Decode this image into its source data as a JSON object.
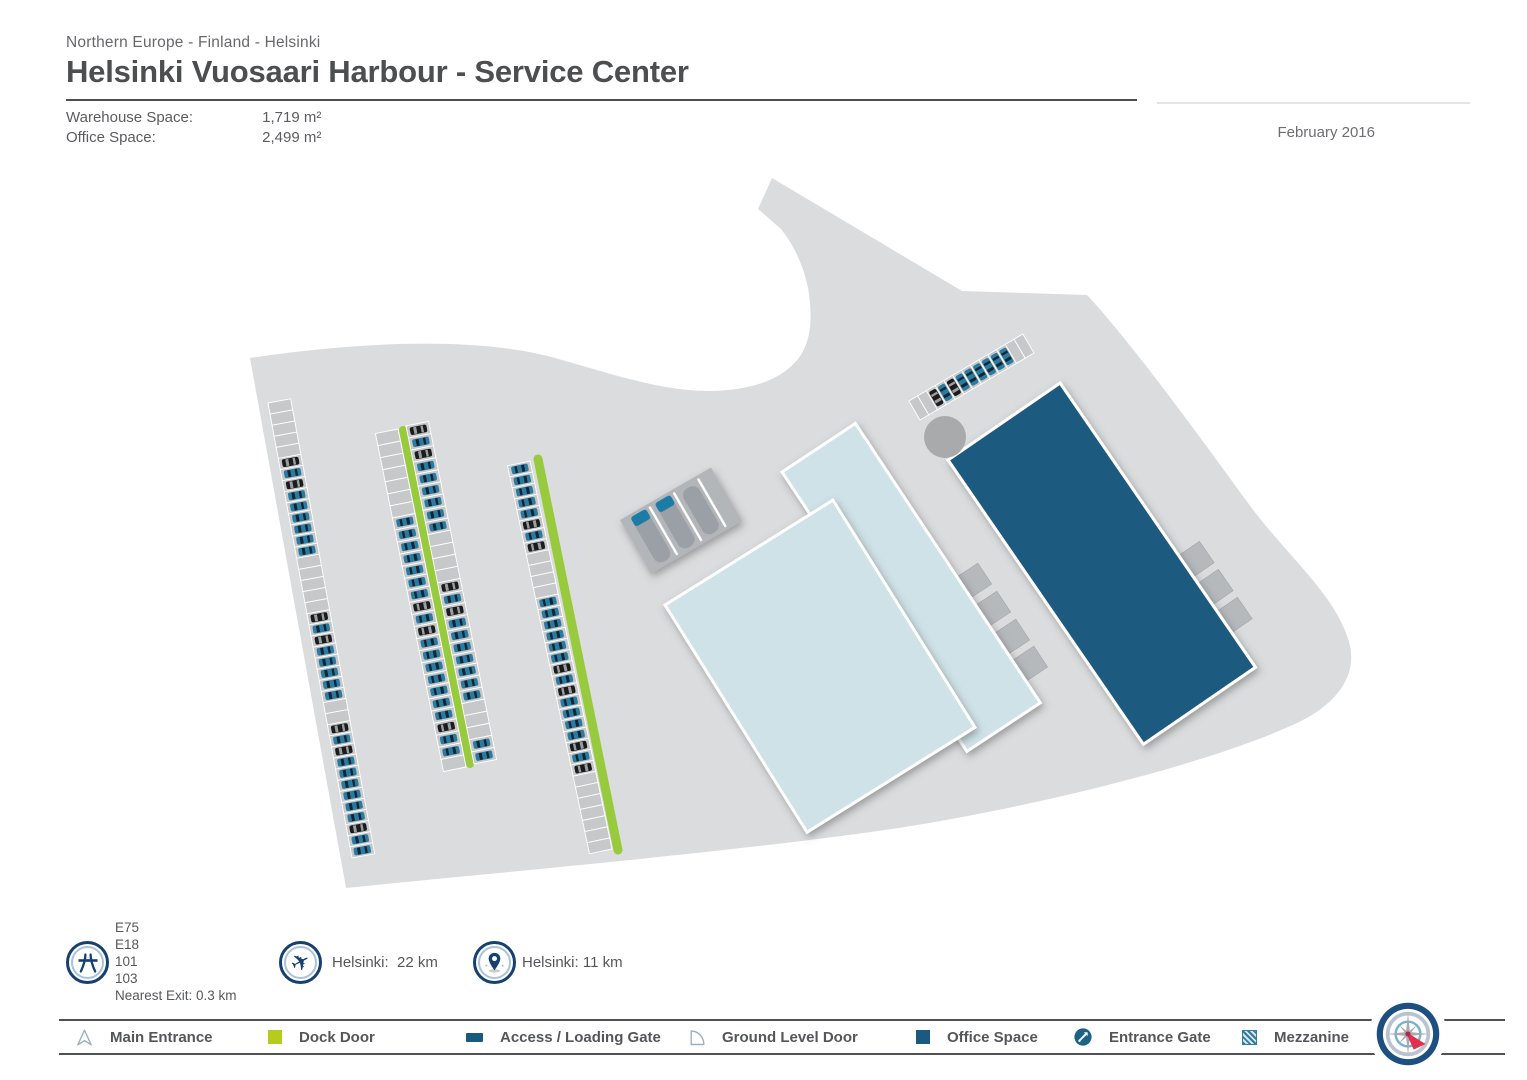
{
  "header": {
    "breadcrumb": "Northern Europe - Finland - Helsinki",
    "title": "Helsinki Vuosaari Harbour - Service Center",
    "stats": [
      {
        "label": "Warehouse Space:",
        "value": "1,719 m²"
      },
      {
        "label": "Office Space:",
        "value": "2,499 m²"
      }
    ],
    "date": "February 2016"
  },
  "footer": {
    "motorway_roads": [
      "E75",
      "E18",
      "101",
      "103"
    ],
    "nearest_exit": "Nearest Exit: 0.3 km",
    "airport_distance": "Helsinki:  22 km",
    "city_distance": "Helsinki: 11 km"
  },
  "legend": {
    "items": [
      {
        "icon": "main-entrance-icon",
        "label": "Main Entrance"
      },
      {
        "icon": "dock-door-icon",
        "label": "Dock Door"
      },
      {
        "icon": "access-loading-gate-icon",
        "label": "Access / Loading Gate"
      },
      {
        "icon": "ground-level-door-icon",
        "label": "Ground Level Door"
      },
      {
        "icon": "office-space-icon",
        "label": "Office Space"
      },
      {
        "icon": "entrance-gate-icon",
        "label": "Entrance Gate"
      },
      {
        "icon": "mezzanine-icon",
        "label": "Mezzanine"
      }
    ]
  },
  "map": {
    "colors": {
      "land": "#dbdcdd",
      "stall": "#c6c8ca",
      "green": "#98ca3d",
      "carBlue": "#2b7aa0",
      "carBlueBand": "#102634",
      "carBlack": "#1b1b1b",
      "carBlackBand": "#999ea2",
      "light": "#cfe2e8",
      "dark": "#1a5a80",
      "dock": "#b6b9bc",
      "ramp": "#b3b6b9",
      "lane": "#9aa0a5",
      "laneTip": "#1d7ba6",
      "circle": "#a8aaac"
    },
    "land_path": "M 250,358 C 330,346 470,332 562,360 C 612,374 658,390 706,391 C 752,391 782,379 798,359 C 809,345 812,326 810,303 C 808,276 797,249 781,229 L 758,209 L 772,178 L 962,291 L 1087,295 C 1128,339 1187,419 1248,503 C 1289,559 1338,596 1350,646 C 1357,679 1333,706 1297,723 C 1220,759 1065,801 905,827 C 740,852 480,874 346,888 Z",
    "green_strips": [
      {
        "x1": 403,
        "y1": 430,
        "x2": 470,
        "y2": 764,
        "w": 8
      },
      {
        "x1": 538,
        "y1": 459,
        "x2": 618,
        "y2": 850,
        "w": 9
      }
    ],
    "parking_rows": [
      {
        "name": "parking-row-west",
        "x1": 268,
        "y1": 403,
        "x2": 352,
        "y2": 858,
        "depth": 23,
        "side": -1,
        "pattern": "eeeeekbkbbbbbbeeeeekbkbbbbbeekbkbbbbbbkbb"
      },
      {
        "name": "parking-row-center-left",
        "x1": 398,
        "y1": 429,
        "x2": 466,
        "y2": 767,
        "depth": 23,
        "side": 1,
        "pattern": "eeeeeeebbbbbbbkbkbbbbbbbkbbe"
      },
      {
        "name": "parking-row-center-right",
        "x1": 406,
        "y1": 426,
        "x2": 474,
        "y2": 764,
        "depth": 23,
        "side": -1,
        "pattern": "kbkbbbbbbeeeekbkbbbbbbbeeebb"
      },
      {
        "name": "parking-row-east",
        "x1": 530,
        "y1": 461,
        "x2": 612,
        "y2": 849,
        "depth": 23,
        "side": 1,
        "pattern": "bbbbbkbkeeeebbbbbbkbkbbbbkbkeeeeeee"
      },
      {
        "name": "parking-row-northeast",
        "x1": 920,
        "y1": 420,
        "x2": 1034,
        "y2": 353,
        "depth": 22,
        "side": -1,
        "pattern": "eekbkbbbbbbee"
      }
    ],
    "ramp": {
      "x": 620,
      "y": 520,
      "angle": -30,
      "w": 105,
      "h": 62
    },
    "docks_back": [
      {
        "x": 957,
        "y": 577,
        "a": -33.5,
        "s": 25
      },
      {
        "x": 976,
        "y": 605,
        "a": -33.5,
        "s": 25
      },
      {
        "x": 995,
        "y": 633,
        "a": -33.5,
        "s": 25
      },
      {
        "x": 1013,
        "y": 660,
        "a": -33.5,
        "s": 25
      }
    ],
    "docks_office": [
      {
        "x": 1178,
        "y": 556,
        "a": -34.5,
        "s": 26
      },
      {
        "x": 1197,
        "y": 584,
        "a": -34.5,
        "s": 26
      },
      {
        "x": 1216,
        "y": 612,
        "a": -34.5,
        "s": 26
      }
    ],
    "buildings": [
      {
        "name": "warehouse-back-building",
        "x": 782,
        "y": 472,
        "angle": -33.5,
        "w": 88,
        "h": 335,
        "fill": "light"
      },
      {
        "name": "office-space-building",
        "x": 948,
        "y": 460,
        "angle": -34.5,
        "w": 136,
        "h": 345,
        "fill": "dark"
      },
      {
        "name": "warehouse-front-building",
        "x": 665,
        "y": 605,
        "angle": -32,
        "w": 198,
        "h": 268,
        "fill": "light"
      }
    ],
    "roundabout": {
      "cx": 945,
      "cy": 437,
      "r": 21
    }
  }
}
